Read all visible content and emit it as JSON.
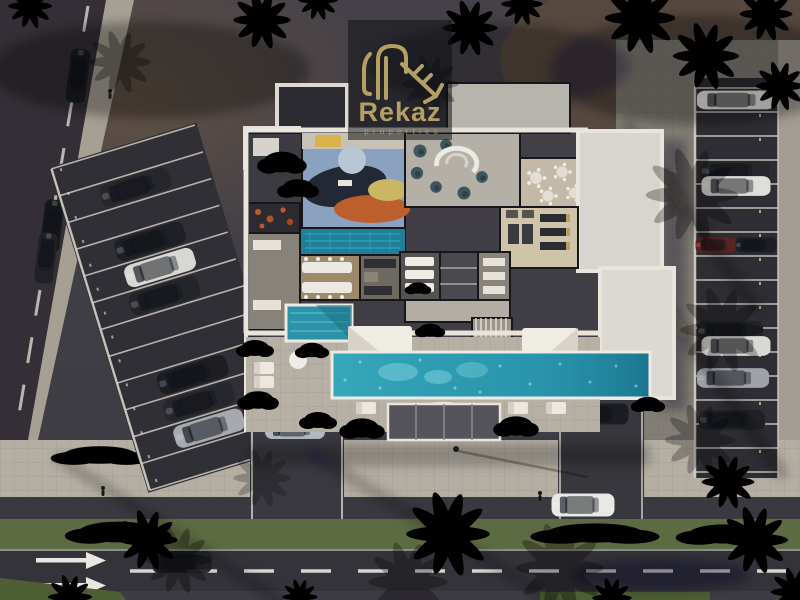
{
  "meta": {
    "scene": "Aerial dusk render of a residential amenity building with outdoor pool, courtyards, angled parking lot, parallel parking strip and landscaped street",
    "view": "top-down",
    "lighting": "dusk golden-hour with long palm shadows"
  },
  "logo": {
    "brand": "Rekaz",
    "tagline": "properties",
    "monogram": "key-R-icon",
    "color": "#b49f64"
  },
  "palette": {
    "asphalt": "#413f46",
    "street": "#352f36",
    "sidewalk": "#a8a298",
    "plaza": "#b4aea3",
    "road": "#34333a",
    "grass": "#5d6b42",
    "hedge": "#2e431f",
    "roof_white": "#e7e3da",
    "roof_light": "#bab6af",
    "pool": "#2e9ab0",
    "indoor_pool": "#1f7f98",
    "small_pool": "#2b93a8",
    "canopy": "#55535b",
    "gold": "#b49f64",
    "marking": "#e9e7e0",
    "car_dark": "#212227",
    "car_white": "#e2e1dd",
    "car_silver": "#a7abb0",
    "car_red": "#5a2420",
    "palm_green": "#3a5a2d",
    "palm_bright": "#4c7a33",
    "palm_brown": "#6a5336"
  },
  "scene": {
    "features": [
      "building floor plan with furnished interiors",
      "art-rug lounge room",
      "lounge with teal poufs and spiral feature",
      "round-table dining nook",
      "gym with equipment rows",
      "indoor lap pool",
      "banquet tables and kitchen",
      "spa beds and bathrooms",
      "staircase",
      "small courtyard plunge pool",
      "main outdoor pool with sun loungers",
      "garden courtyard with parasol",
      "angled parking rows (left)",
      "parallel parking strip (right)",
      "street with dashed lane line (left)",
      "access road, hedge median, main road with arrows (bottom)",
      "palm trees, pedestrians, street lamp"
    ],
    "vehicle_counts": {
      "left_lot_parked": 7,
      "right_strip_parked": 8,
      "street_parked_or_moving": 4,
      "driveway_cars": 3,
      "garage_alcove_car": 1
    }
  }
}
